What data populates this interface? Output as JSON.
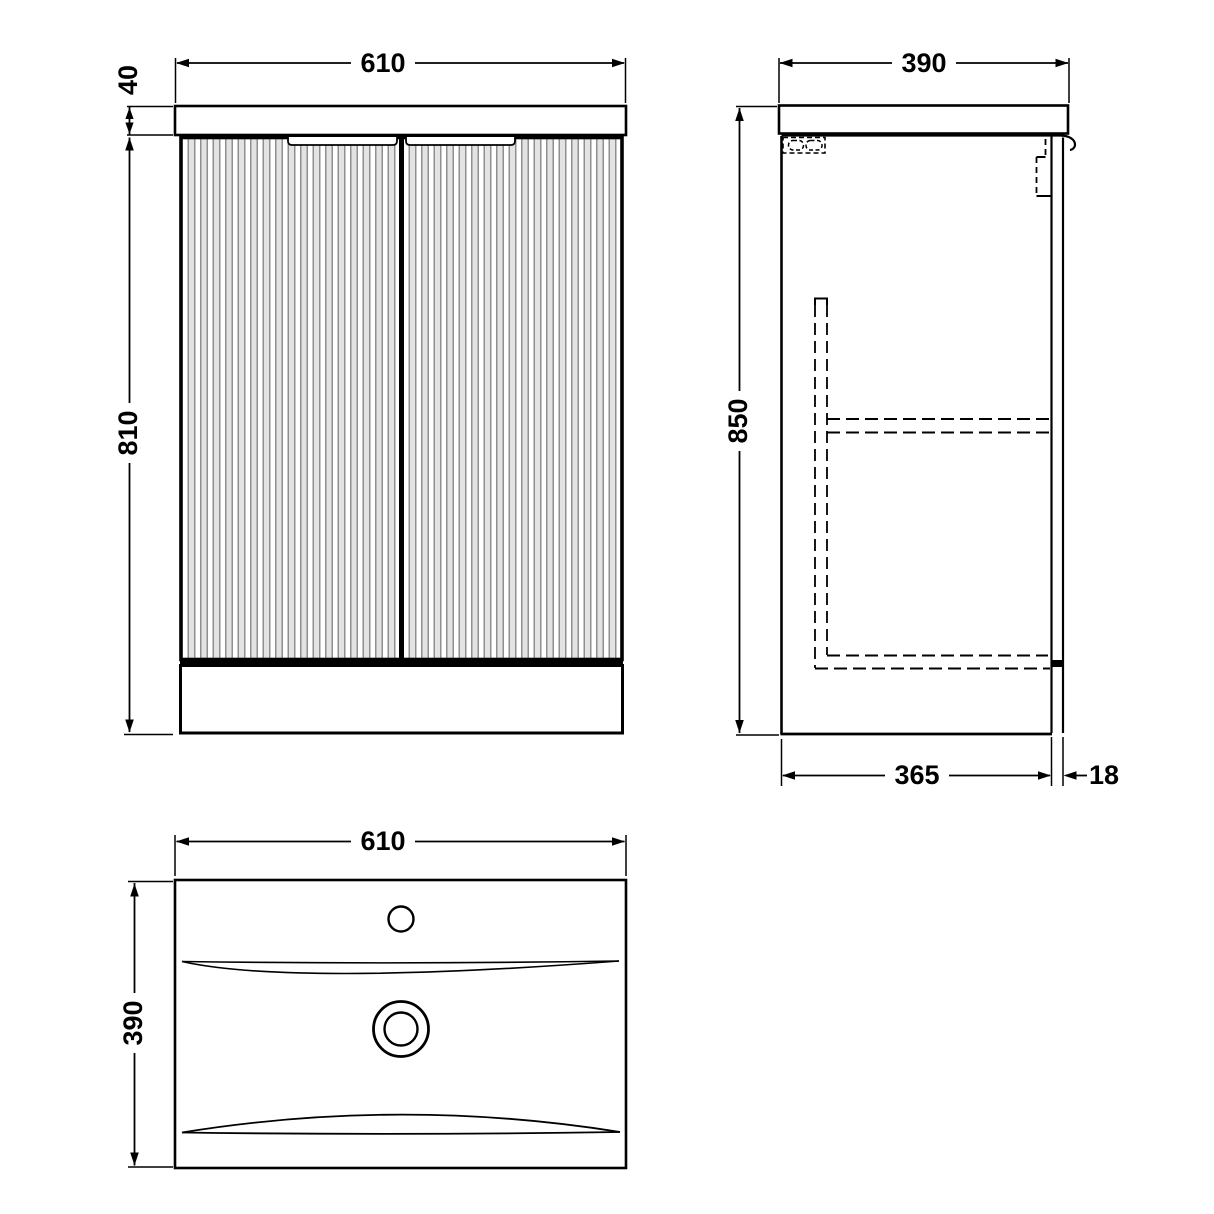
{
  "dims": {
    "front_width": "610",
    "front_counter_thickness": "40",
    "front_body_height": "810",
    "side_depth": "390",
    "side_overall_height": "850",
    "side_carcass_depth": "365",
    "side_panel_thickness": "18",
    "plan_width": "610",
    "plan_depth": "390"
  },
  "colors": {
    "line": "#000000",
    "flute_gray": "#8f8f8f",
    "background": "#ffffff"
  }
}
